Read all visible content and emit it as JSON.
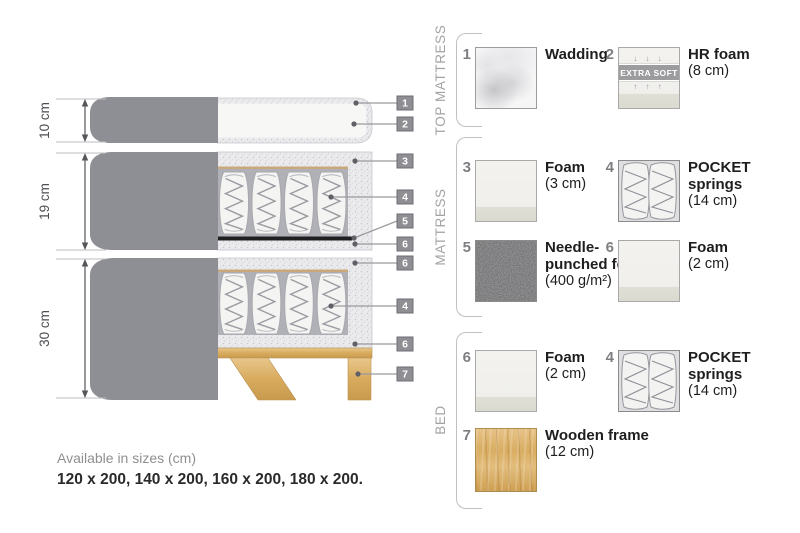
{
  "diagram": {
    "dimensions": [
      {
        "label": "10 cm"
      },
      {
        "label": "19 cm"
      },
      {
        "label": "30 cm"
      }
    ],
    "callouts": [
      "1",
      "2",
      "3",
      "4",
      "5",
      "6",
      "6",
      "4",
      "6",
      "7"
    ]
  },
  "legend": {
    "sections": [
      {
        "label": "TOP MATTRESS"
      },
      {
        "label": "MATTRESS"
      },
      {
        "label": "BED"
      }
    ],
    "items": [
      {
        "num": "1",
        "name": "Wadding",
        "detail": ""
      },
      {
        "num": "2",
        "name": "HR foam",
        "detail": "(8 cm)",
        "badge": "EXTRA SOFT",
        "badge_arrows_down": "↓ ↓ ↓",
        "badge_arrows_up": "↑ ↑ ↑"
      },
      {
        "num": "3",
        "name": "Foam",
        "detail": "(3 cm)"
      },
      {
        "num": "4",
        "name": "POCKET springs",
        "detail": "(14 cm)"
      },
      {
        "num": "5",
        "name": "Needle-punched felt",
        "detail": "(400 g/m²)"
      },
      {
        "num": "6",
        "name": "Foam",
        "detail": "(2 cm)"
      },
      {
        "num": "6",
        "name": "Foam",
        "detail": "(2 cm)"
      },
      {
        "num": "4",
        "name": "POCKET springs",
        "detail": "(14 cm)"
      },
      {
        "num": "7",
        "name": "Wooden frame",
        "detail": "(12 cm)"
      }
    ]
  },
  "footer": {
    "sizes_title": "Available in sizes (cm)",
    "sizes_values": "120 x 200, 140 x 200, 160 x 200, 180 x 200."
  },
  "colors": {
    "cover_gray": "#8e8e95",
    "foam_speckle": "#ebebed",
    "springs_background": "#b0b0b7",
    "wood": "#d9ad62",
    "felt_black": "#1f1f22",
    "callout_box": "#8f8f93",
    "tan_line": "#c9a87c"
  }
}
